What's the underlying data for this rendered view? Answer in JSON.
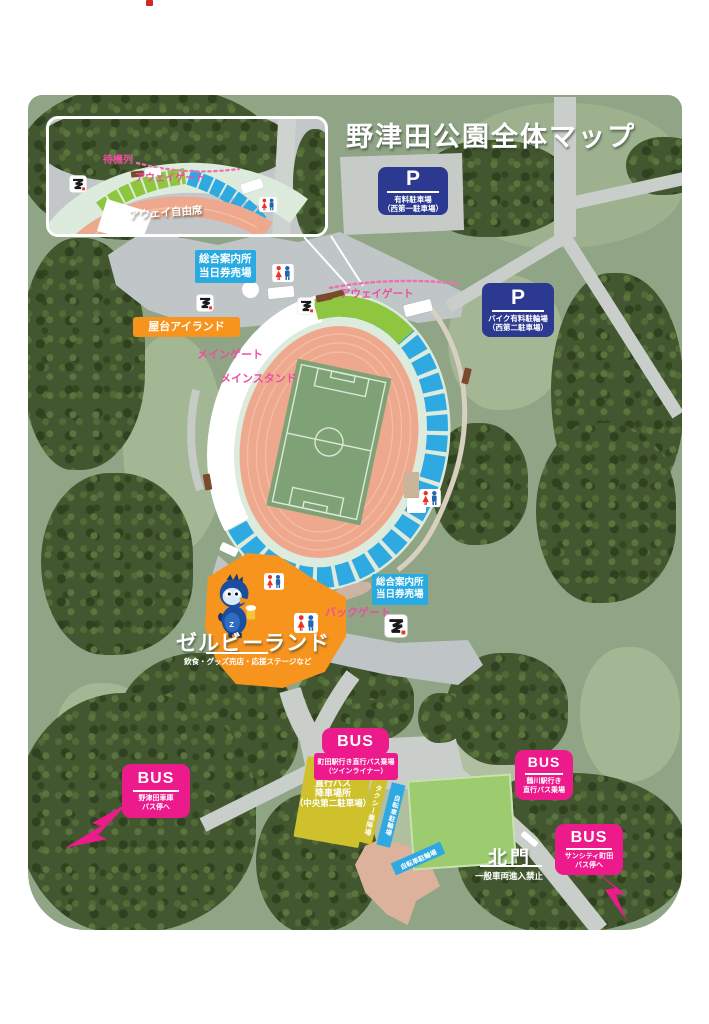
{
  "title": "野津田公園全体マップ",
  "inset": {
    "waiting_line": "待機列",
    "away_gate": "アウェイゲート",
    "away_seats": "アウェイ自由席"
  },
  "parking": {
    "p1": {
      "symbol": "P",
      "line1": "有料駐車場",
      "line2": "（西第一駐車場）"
    },
    "p2": {
      "symbol": "P",
      "line1": "バイク有料駐輪場",
      "line2": "（西第二駐車場）"
    }
  },
  "info": {
    "top": {
      "line1": "総合案内所",
      "line2": "当日券売場"
    },
    "back": {
      "line1": "総合案内所",
      "line2": "当日券売場"
    }
  },
  "labels": {
    "yatai": "屋台アイランド",
    "main_gate": "メインゲート",
    "main_stand": "メインスタンド",
    "away_gate_main": "アウェイゲート",
    "back_gate": "バックゲート"
  },
  "zelvy": {
    "name": "ゼルビーランド",
    "description": "飲食・グッズ売店・応援ステージなど"
  },
  "bus": {
    "machida": {
      "badge": "BUS",
      "line1": "町田駅行き直行バス乗場",
      "line2": "（ツインライナー）"
    },
    "tsurukawa": {
      "badge": "BUS",
      "line1": "鶴川駅行き",
      "line2": "直行バス乗場"
    },
    "nozuta": {
      "badge": "BUS",
      "line1": "野津田車庫",
      "line2": "バス停へ"
    },
    "suncity": {
      "badge": "BUS",
      "line1": "サンシティ町田",
      "line2": "バス停へ"
    }
  },
  "zones": {
    "dropoff": {
      "line1": "直行バス",
      "line2": "降車場所",
      "line3": "（中央第二駐車場）"
    },
    "taxi": "タクシー乗降場",
    "bicycle_a": "自転車駐輪場",
    "bicycle_b": "自転車駐輪場"
  },
  "north_gate": {
    "name": "北門",
    "note": "一般車両進入禁止"
  },
  "colors": {
    "bus_pink": "#ec1a8b",
    "parking_blue": "#2b3990",
    "info_blue": "#29abe2",
    "orange": "#f7941d",
    "map_green": "#8fa585",
    "seat_blue": "#2fa9e2",
    "seat_green": "#8ec63f",
    "track_salmon": "#eda88d",
    "pitch_green": "#7ea275",
    "field_green": "#9ccb70",
    "taxi_yellow": "#cfc12b"
  }
}
